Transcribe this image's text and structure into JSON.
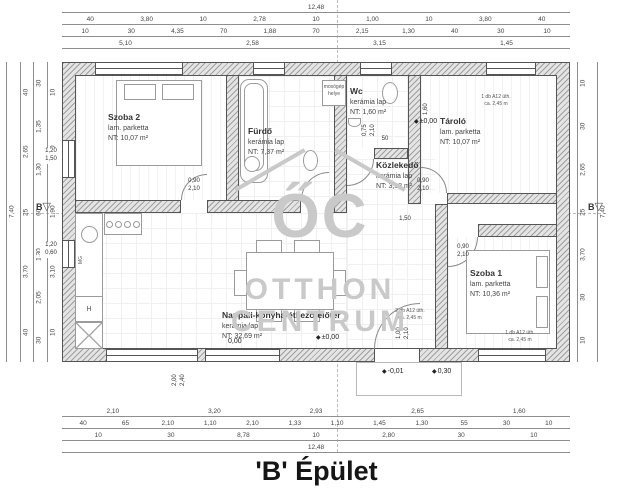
{
  "title": "'B' Épület",
  "watermark": {
    "logo": "ŐC",
    "line1": "OTTHON",
    "line2": "CENTRUM"
  },
  "section_marker": "B",
  "rooms": [
    {
      "name": "Szoba 2",
      "floor": "lam. parketta",
      "area": "NT: 10,07 m²"
    },
    {
      "name": "Fürdő",
      "floor": "kerámia lap",
      "area": "NT: 7,37 m²"
    },
    {
      "name": "Wc",
      "floor": "kerámia lap",
      "area": "NT: 1,60 m²"
    },
    {
      "name": "Tároló",
      "floor": "lam. parketta",
      "area": "NT: 10,07 m²"
    },
    {
      "name": "Közlekedő",
      "floor": "kerámia lap",
      "area": "NT: 3,18 m²"
    },
    {
      "name": "Szoba 1",
      "floor": "lam. parketta",
      "area": "NT: 10,36 m²"
    },
    {
      "name": "Nappali-konyha-étkező-előtér",
      "floor": "kerámia lap",
      "area": "NT: 32,69 m²"
    }
  ],
  "dimensions": {
    "top": [
      [
        "12,48"
      ],
      [
        "40",
        "3,80",
        "10",
        "2,78",
        "10",
        "1,00",
        "10",
        "3,80",
        "40"
      ],
      [
        "10",
        "30",
        "4,35",
        "70",
        "1,88",
        "70",
        "2,15",
        "1,30",
        "40",
        "30",
        "10"
      ],
      [
        "5,10",
        "2,58",
        "3,15",
        "1,45"
      ]
    ],
    "bottom": [
      [
        "2,10",
        "3,20",
        "2,93",
        "2,65",
        "1,60"
      ],
      [
        "40",
        "65",
        "2,10",
        "1,10",
        "2,10",
        "1,33",
        "1,10",
        "1,45",
        "1,30",
        "55",
        "30",
        "10"
      ],
      [
        "10",
        "30",
        "8,78",
        "10",
        "2,80",
        "30",
        "10"
      ],
      [
        "12,48"
      ]
    ],
    "left": [
      [
        "7,40"
      ],
      [
        "40",
        "2,65",
        "25",
        "3,70",
        "40"
      ],
      [
        "30",
        "1,35",
        "1,30",
        "60",
        "1,30",
        "2,05",
        "30"
      ],
      [
        "10",
        "2,40",
        "1,90",
        "3,10",
        "10"
      ]
    ],
    "right": [
      [
        "10",
        "30",
        "2,65",
        "25",
        "3,70",
        "30",
        "10"
      ],
      [
        "7,40"
      ]
    ]
  },
  "labels": {
    "door_standard": "0,90\n2,10",
    "door_wc": "0,75\n2,10",
    "door_entrance": "1,00\n2,10",
    "window_szoba2": "1,20\n1,50",
    "window_kitchen": "1,20\n0,60",
    "window_terrace": "2,00\n2,40",
    "corridor_width": "1,50",
    "wc_width": "50",
    "tarolo_height": "1,60",
    "step_depth": "0,30",
    "radiator_single": "1 db A12 üth.\nca. 2,45 m",
    "radiator_double": "2 db A12 üth.\nca. 2,45 m",
    "washing_machine": "mosógép\nhelye",
    "fridge": "H",
    "dishwasher": "MG"
  },
  "levels": {
    "zero_plusminus": "±0,00",
    "zero": "0,00",
    "minus_one": "-0,01"
  },
  "colors": {
    "wall_fill": "#e4e4e4",
    "hatch_line": "#9f9f9f",
    "outline": "#555555",
    "dimension_text": "#444444",
    "watermark": "#c9c9c9",
    "text": "#333333"
  }
}
